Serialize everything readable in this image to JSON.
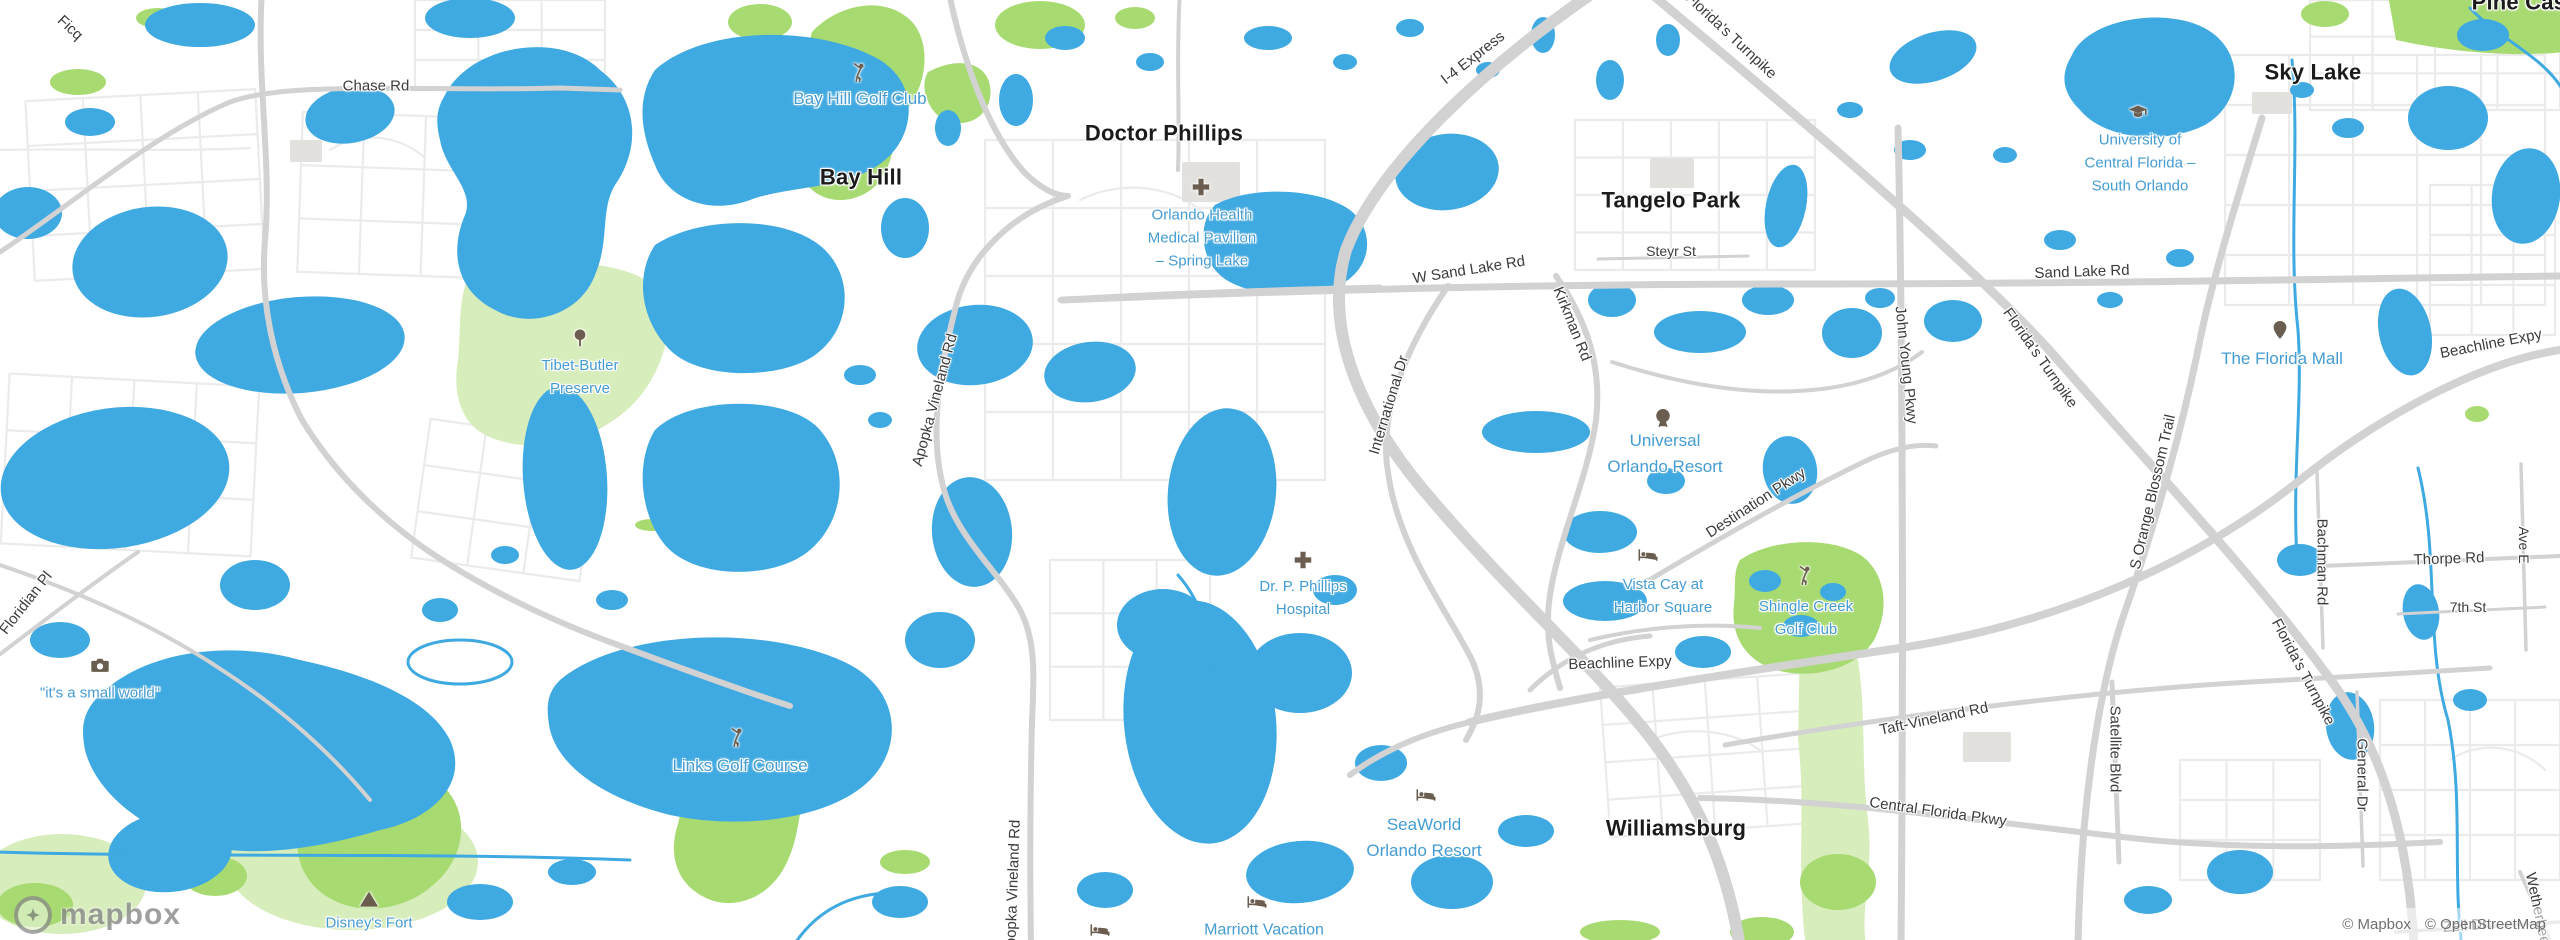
{
  "map": {
    "palette": {
      "land": "#ffffff",
      "water": "#3fa9e1",
      "park_bright": "#a8da72",
      "park_pale": "#d8edbc",
      "road_major": "#d2d2d2",
      "road_minor": "#ebebeb",
      "building": "#e3e1de",
      "label_city": "#1b1b1b",
      "label_road": "#3c3c3c",
      "label_poi": "#459cd3",
      "icon": "#6b5d4f"
    },
    "logo_text": "mapbox",
    "attribution": {
      "mapbox_credit": "© Mapbox",
      "osm_credit": "© OpenStreetMap"
    },
    "city_labels": [
      {
        "text": "Doctor Phillips",
        "x": 1164,
        "y": 133,
        "size": 22,
        "rotation": 0
      },
      {
        "text": "Bay Hill",
        "x": 861,
        "y": 177,
        "size": 22,
        "rotation": 0
      },
      {
        "text": "Tangelo Park",
        "x": 1671,
        "y": 200,
        "size": 22,
        "rotation": 0
      },
      {
        "text": "Sky Lake",
        "x": 2313,
        "y": 72,
        "size": 22,
        "rotation": 0
      },
      {
        "text": "Williamsburg",
        "x": 1676,
        "y": 828,
        "size": 22,
        "rotation": 0
      },
      {
        "text": "Pine Castle",
        "x": 2532,
        "y": 2,
        "size": 22,
        "rotation": 0
      }
    ],
    "road_labels": [
      {
        "text": "Chase Rd",
        "x": 376,
        "y": 86,
        "size": 15,
        "rotation": 0
      },
      {
        "text": "Ficq",
        "x": 70,
        "y": 28,
        "size": 15,
        "rotation": 43
      },
      {
        "text": "I-4 Express",
        "x": 1473,
        "y": 58,
        "size": 15,
        "rotation": -38
      },
      {
        "text": "Florida's Turnpike",
        "x": 1731,
        "y": 36,
        "size": 15,
        "rotation": 43
      },
      {
        "text": "W Sand Lake Rd",
        "x": 1469,
        "y": 270,
        "size": 15,
        "rotation": -9
      },
      {
        "text": "Steyr St",
        "x": 1671,
        "y": 251,
        "size": 14,
        "rotation": 0
      },
      {
        "text": "Sand Lake Rd",
        "x": 2082,
        "y": 272,
        "size": 15,
        "rotation": -2
      },
      {
        "text": "Kirkman Rd",
        "x": 1572,
        "y": 324,
        "size": 15,
        "rotation": 68
      },
      {
        "text": "International Dr",
        "x": 1389,
        "y": 405,
        "size": 15,
        "rotation": -73
      },
      {
        "text": "Apopka Vineland Rd",
        "x": 935,
        "y": 400,
        "size": 15,
        "rotation": -75
      },
      {
        "text": "Apopka Vineland Rd",
        "x": 1013,
        "y": 888,
        "size": 15,
        "rotation": -88
      },
      {
        "text": "John Young Pkwy",
        "x": 1906,
        "y": 365,
        "size": 15,
        "rotation": 84
      },
      {
        "text": "Florida's Turnpike",
        "x": 2040,
        "y": 358,
        "size": 15,
        "rotation": 55
      },
      {
        "text": "Florida's Turnpike",
        "x": 2303,
        "y": 672,
        "size": 15,
        "rotation": 62
      },
      {
        "text": "Destination Pkwy",
        "x": 1756,
        "y": 503,
        "size": 15,
        "rotation": -33
      },
      {
        "text": "Beachline Expy",
        "x": 1620,
        "y": 663,
        "size": 15,
        "rotation": -2
      },
      {
        "text": "Beachline Expy",
        "x": 2491,
        "y": 344,
        "size": 15,
        "rotation": -11
      },
      {
        "text": "S Orange Blossom Trail",
        "x": 2153,
        "y": 492,
        "size": 15,
        "rotation": -77
      },
      {
        "text": "Taft-Vineland Rd",
        "x": 1934,
        "y": 719,
        "size": 15,
        "rotation": -12
      },
      {
        "text": "Central Florida Pkwy",
        "x": 1938,
        "y": 812,
        "size": 15,
        "rotation": 8
      },
      {
        "text": "Satellite Blvd",
        "x": 2115,
        "y": 749,
        "size": 15,
        "rotation": 90
      },
      {
        "text": "Bachman Rd",
        "x": 2322,
        "y": 562,
        "size": 15,
        "rotation": 90
      },
      {
        "text": "Thorpe Rd",
        "x": 2449,
        "y": 559,
        "size": 15,
        "rotation": -2
      },
      {
        "text": "Ave E",
        "x": 2524,
        "y": 545,
        "size": 14,
        "rotation": 90
      },
      {
        "text": "7th St",
        "x": 2468,
        "y": 607,
        "size": 14,
        "rotation": 0
      },
      {
        "text": "General Dr",
        "x": 2362,
        "y": 775,
        "size": 15,
        "rotation": 90
      },
      {
        "text": "Floridian Pl",
        "x": 26,
        "y": 603,
        "size": 15,
        "rotation": -52
      },
      {
        "text": "Zell Dr",
        "x": 2465,
        "y": 926,
        "size": 15,
        "rotation": -4
      },
      {
        "text": "Wetherbee Rd",
        "x": 2540,
        "y": 920,
        "size": 15,
        "rotation": 78
      }
    ],
    "poi_labels": [
      {
        "lines": [
          "Bay Hill Golf Club"
        ],
        "x": 860,
        "y": 99,
        "size": 17,
        "icon": "golfer-icon",
        "icon_x": 859,
        "icon_y": 73
      },
      {
        "lines": [
          "Orlando Health",
          "Medical Pavilion",
          "– Spring Lake"
        ],
        "x": 1202,
        "y": 238,
        "size": 15,
        "icon": "hospital-cross-icon",
        "icon_x": 1201,
        "icon_y": 187
      },
      {
        "lines": [
          "University of",
          "Central Florida –",
          "South Orlando"
        ],
        "x": 2140,
        "y": 163,
        "size": 15,
        "icon": "graduation-cap-icon",
        "icon_x": 2138,
        "icon_y": 112
      },
      {
        "lines": [
          "Universal",
          "Orlando Resort"
        ],
        "x": 1665,
        "y": 454,
        "size": 17,
        "icon": "ferris-wheel-icon",
        "icon_x": 1663,
        "icon_y": 418
      },
      {
        "lines": [
          "The Florida Mall"
        ],
        "x": 2282,
        "y": 359,
        "size": 17,
        "icon": "map-pin-icon",
        "icon_x": 2280,
        "icon_y": 330
      },
      {
        "lines": [
          "Dr. P. Phillips",
          "Hospital"
        ],
        "x": 1303,
        "y": 598,
        "size": 15,
        "icon": "hospital-cross-icon",
        "icon_x": 1303,
        "icon_y": 560
      },
      {
        "lines": [
          "Vista Cay at",
          "Harbor Square"
        ],
        "x": 1663,
        "y": 596,
        "size": 15,
        "icon": "bed-icon",
        "icon_x": 1648,
        "icon_y": 555
      },
      {
        "lines": [
          "Shingle Creek",
          "Golf Club"
        ],
        "x": 1806,
        "y": 618,
        "size": 15,
        "icon": "golfer-icon",
        "icon_x": 1805,
        "icon_y": 576
      },
      {
        "lines": [
          "SeaWorld",
          "Orlando Resort"
        ],
        "x": 1424,
        "y": 838,
        "size": 17,
        "icon": "bed-icon",
        "icon_x": 1426,
        "icon_y": 795
      },
      {
        "lines": [
          "Marriott Vacation"
        ],
        "x": 1264,
        "y": 930,
        "size": 16,
        "icon": "bed-icon",
        "icon_x": 1257,
        "icon_y": 902
      },
      {
        "lines": [
          "\"it's a small world\""
        ],
        "x": 100,
        "y": 693,
        "size": 15,
        "icon": "camera-icon",
        "icon_x": 100,
        "icon_y": 665
      },
      {
        "lines": [
          "Links Golf Course"
        ],
        "x": 740,
        "y": 766,
        "size": 17,
        "icon": "golfer-icon",
        "icon_x": 737,
        "icon_y": 738
      },
      {
        "lines": [
          "Tibet-Butler",
          "Preserve"
        ],
        "x": 580,
        "y": 377,
        "size": 15,
        "icon": "tree-icon",
        "icon_x": 580,
        "icon_y": 338
      },
      {
        "lines": [
          "Disney's Fort"
        ],
        "x": 369,
        "y": 923,
        "size": 15,
        "icon": "tent-icon",
        "icon_x": 369,
        "icon_y": 899
      },
      {
        "lines": [],
        "x": 1100,
        "y": 930,
        "size": 15,
        "icon": "bed-icon",
        "icon_x": 1100,
        "icon_y": 930
      }
    ]
  }
}
